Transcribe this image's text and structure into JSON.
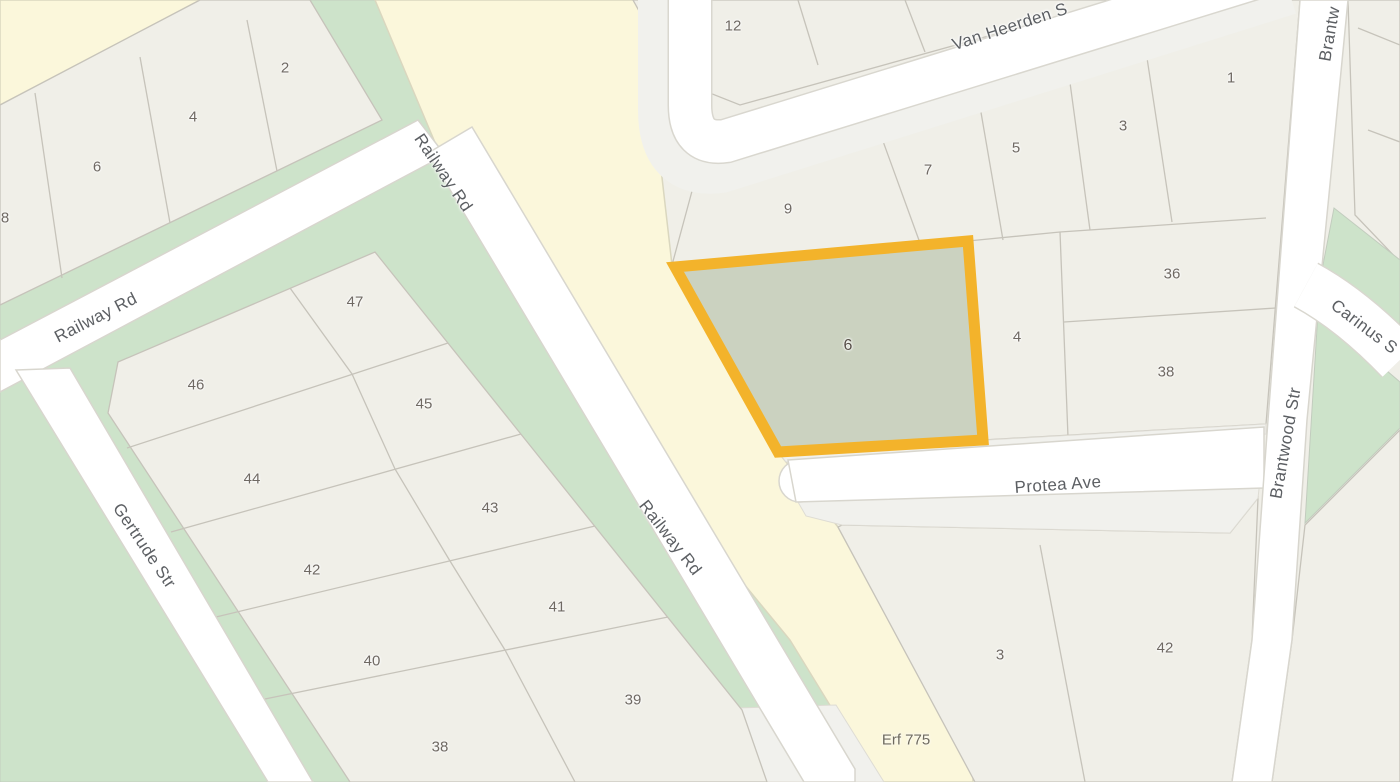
{
  "map": {
    "type": "cadastral-parcel-map",
    "highlight": {
      "parcel_label": "6",
      "outline_color": "#F3B32B",
      "fill_color": "#CBD2C0"
    },
    "streets": {
      "railway_1": "Railway Rd",
      "railway_2": "Railway Rd",
      "railway_3": "Railway Rd",
      "gertrude": "Gertrude Str",
      "van_heerden": "Van Heerden S",
      "protea": "Protea Ave",
      "brantwood": "Brantwood Str",
      "brantwood_top": "Brantw",
      "carinus": "Carinus S"
    },
    "parcels": {
      "top_left_block": [
        "8",
        "6",
        "4",
        "2"
      ],
      "top_center_block": [
        "12"
      ],
      "van_heerden_row": [
        "9",
        "7",
        "5",
        "3",
        "1"
      ],
      "brantwood_side": [
        "36",
        "38",
        "4"
      ],
      "middle_block": [
        "47",
        "46",
        "45",
        "44",
        "43",
        "42",
        "41",
        "40",
        "39",
        "38"
      ],
      "south_block": [
        "3",
        "42"
      ],
      "erf_label": "Erf 775"
    },
    "colors": {
      "parcel_fill": "#F0EFE8",
      "open_space_green": "#CDE3CA",
      "major_road_yellow": "#FBF7DB",
      "road_white": "#FFFFFF",
      "boundary_gray": "#C6C3BA"
    }
  }
}
